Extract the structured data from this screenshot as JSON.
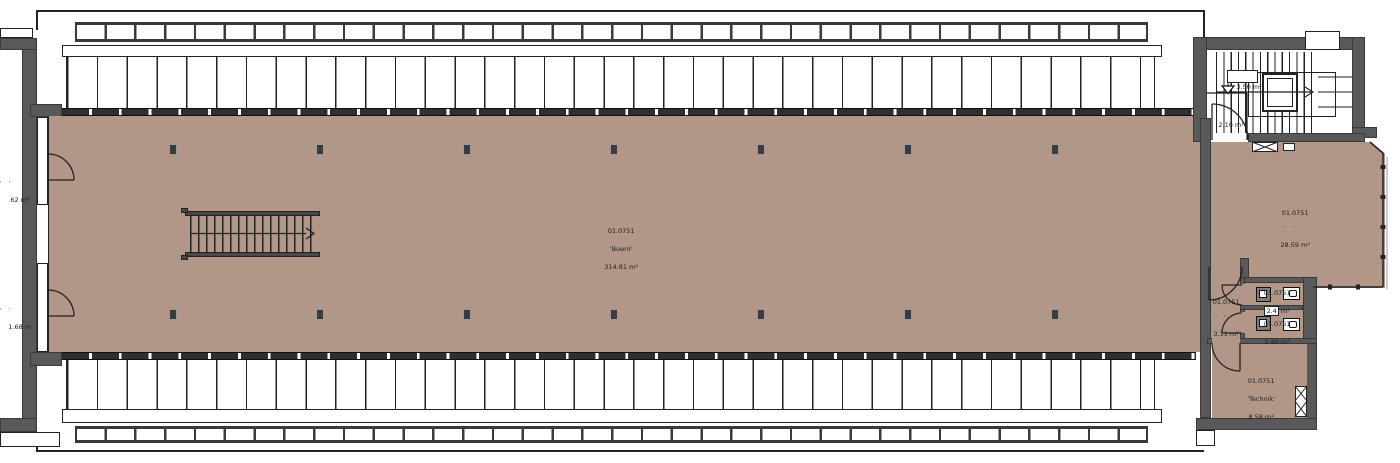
{
  "colors": {
    "room_fill": "#b29688",
    "wall": "#595959",
    "line": "#222222"
  },
  "rooms": {
    "buero": {
      "number": "01.0751",
      "name": "'Buero'",
      "area": "314.81 m²"
    },
    "meeting": {
      "number": "01.0751",
      "name": "' '",
      "area": "28.59 m²"
    },
    "corridor": {
      "number": "01.0751",
      "name": "' '",
      "area": "3.11 m²"
    },
    "wc1": {
      "number": "01.0751",
      "area_value": "2.4",
      "area_unit": "m²"
    },
    "wc2": {
      "number": "01.0751",
      "area": "2.48 m²"
    },
    "technik": {
      "number": "01.0751",
      "name": "'Technik'",
      "area": "8.58 m²"
    },
    "stair_landing": {
      "name": "' '",
      "area": "3.50 m²"
    },
    "entry_lobby": {
      "area": "2.10 m²"
    },
    "balcony_upper": {
      "name": "' '",
      "area": ".62 m²"
    },
    "balcony_lower": {
      "name": "' '",
      "area": "1.68 m"
    }
  }
}
